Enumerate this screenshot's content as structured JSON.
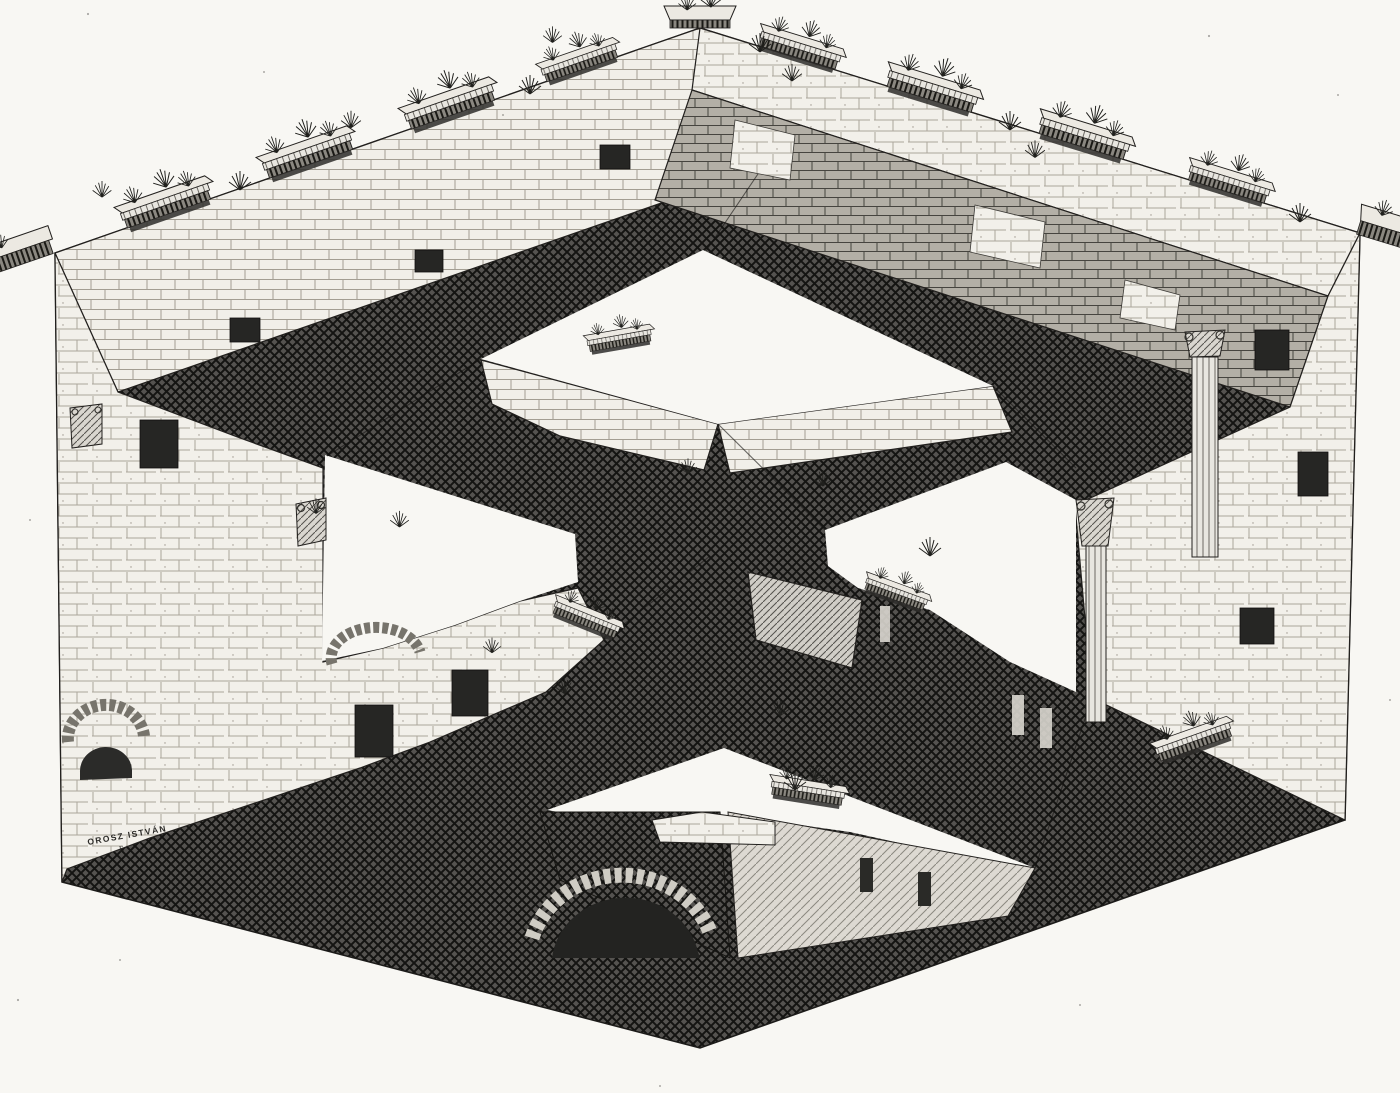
{
  "artwork": {
    "signature": "OROSZ ISTVÁN",
    "signature_mark": "E",
    "palette": {
      "paper": "#f8f7f3",
      "ink": "#1c1c1c",
      "shadow_hatch": "#3a3935",
      "midtone_brick": "#b3afa6",
      "light_stone": "#f2f0ea"
    }
  }
}
